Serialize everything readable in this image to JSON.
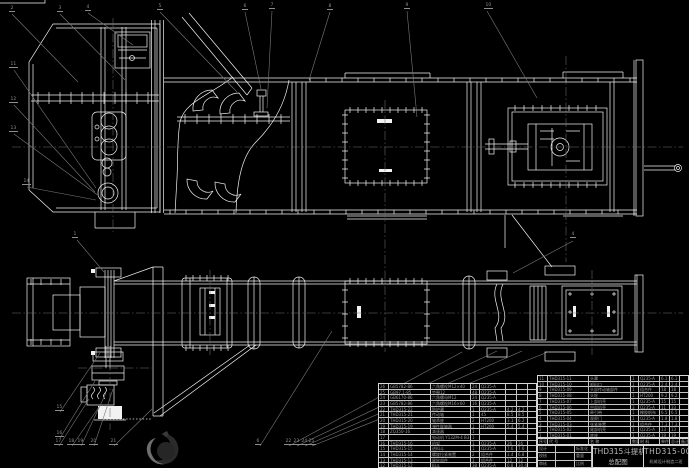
{
  "drawing": {
    "product_title": "THD315斗提机",
    "sheet_title": "总配图",
    "drawing_number": "THD315-00",
    "org_line": "机械设计制造二班"
  },
  "title_block": {
    "sign_rows": [
      [
        "设计",
        "",
        "标准化"
      ],
      [
        "校核",
        "",
        "重量"
      ],
      [
        "审核",
        "",
        "比例"
      ]
    ]
  },
  "bom": {
    "headers": [
      "序号",
      "代  号",
      "名  称",
      "数量",
      "材  料",
      "单件",
      "总计",
      "备注"
    ],
    "left_rows": [
      [
        "26",
        "GB5782-86",
        "六角螺栓M12×40",
        "24",
        "Q235-A",
        "",
        "",
        ""
      ],
      [
        "25",
        "GB97.1-85",
        "垫圈12",
        "48",
        "Q235-A",
        "",
        "",
        ""
      ],
      [
        "24",
        "GB6170-86",
        "六角螺母M12",
        "24",
        "Q235-A",
        "",
        "",
        ""
      ],
      [
        "23",
        "GB5782-86",
        "六角螺栓M16×60",
        "16",
        "Q235-A",
        "",
        "",
        ""
      ],
      [
        "22",
        "THD315-22",
        "防护罩",
        "1",
        "Q235-A",
        "4.2",
        "4.2",
        ""
      ],
      [
        "21",
        "THD315-21",
        "传动轴",
        "1",
        "45",
        "8.5",
        "8.5",
        ""
      ],
      [
        "20",
        "THD315-20",
        "轴承座",
        "2",
        "HT200",
        "3.1",
        "6.2",
        ""
      ],
      [
        "19",
        "THD315-19",
        "弹性联轴器",
        "1",
        "HT200",
        "5.4",
        "5.4",
        ""
      ],
      [
        "18",
        "ZQ350-16",
        "减速器",
        "1",
        "",
        "",
        "",
        ""
      ],
      [
        "17",
        "",
        "电动机 Y132M-4 B3",
        "1",
        "",
        "",
        "",
        ""
      ],
      [
        "16",
        "THD315-16",
        "机架",
        "1",
        "Q235-A",
        "26",
        "26",
        ""
      ],
      [
        "15",
        "THD315-15",
        "进料斗",
        "1",
        "Q235-A",
        "7.6",
        "7.6",
        ""
      ],
      [
        "14",
        "THD315-14",
        "螺旋拉紧装置",
        "2",
        "组合件",
        "3.4",
        "6.8",
        ""
      ],
      [
        "13",
        "THD315-13",
        "尾轮部件",
        "1",
        "组合件",
        "12",
        "12",
        ""
      ],
      [
        "12",
        "THD315-12",
        "料斗",
        "38",
        "Q235-A",
        "0.8",
        "30.4",
        ""
      ]
    ],
    "right_rows": [
      [
        "11",
        "THD315-11",
        "头罩",
        "1",
        "Q235-A",
        "6.1",
        "6.1",
        ""
      ],
      [
        "10",
        "THD315-10",
        "卸料口",
        "1",
        "Q235-A",
        "2.4",
        "2.4",
        ""
      ],
      [
        "9",
        "THD315-09",
        "头部传动轴部件",
        "1",
        "组合件",
        "18",
        "18",
        ""
      ],
      [
        "8",
        "THD315-08",
        "头轮",
        "1",
        "HT200",
        "9.2",
        "9.2",
        ""
      ],
      [
        "7",
        "THD315-07",
        "上部机壳",
        "1",
        "Q235-A",
        "15",
        "15",
        ""
      ],
      [
        "6",
        "THD315-06",
        "中部机壳",
        "3",
        "Q235-A",
        "11",
        "33",
        ""
      ],
      [
        "5",
        "THD315-05",
        "牵引带",
        "1",
        "橡胶帆布",
        "6.5",
        "6.5",
        ""
      ],
      [
        "4",
        "THD315-04",
        "观察门",
        "1",
        "Q235-A",
        "1.8",
        "1.8",
        ""
      ],
      [
        "3",
        "THD315-03",
        "张紧装置",
        "1",
        "组合件",
        "7.3",
        "7.3",
        ""
      ],
      [
        "2",
        "THD315-02",
        "尾部机壳",
        "1",
        "Q235-A",
        "13",
        "13",
        ""
      ],
      [
        "1",
        "THD315-01",
        "底座",
        "1",
        "Q235-A",
        "19",
        "19",
        ""
      ]
    ]
  },
  "callouts": [
    {
      "x": 12,
      "y": 12,
      "label": "2"
    },
    {
      "x": 60,
      "y": 12,
      "label": "3"
    },
    {
      "x": 88,
      "y": 11,
      "label": "4"
    },
    {
      "x": 160,
      "y": 10,
      "label": "5"
    },
    {
      "x": 245,
      "y": 10,
      "label": "6"
    },
    {
      "x": 272,
      "y": 9,
      "label": "7"
    },
    {
      "x": 330,
      "y": 10,
      "label": "8"
    },
    {
      "x": 407,
      "y": 9,
      "label": "9"
    },
    {
      "x": 487,
      "y": 9,
      "label": "10"
    },
    {
      "x": 12,
      "y": 68,
      "label": "11"
    },
    {
      "x": 12,
      "y": 103,
      "label": "12"
    },
    {
      "x": 12,
      "y": 132,
      "label": "13"
    },
    {
      "x": 25,
      "y": 185,
      "label": "14"
    },
    {
      "x": 75,
      "y": 238,
      "label": "1"
    },
    {
      "x": 573,
      "y": 238,
      "label": "4"
    },
    {
      "x": 58,
      "y": 411,
      "label": "15"
    },
    {
      "x": 58,
      "y": 437,
      "label": "16"
    },
    {
      "x": 57,
      "y": 445,
      "label": "17"
    },
    {
      "x": 70,
      "y": 445,
      "label": "18"
    },
    {
      "x": 79,
      "y": 445,
      "label": "19"
    },
    {
      "x": 92,
      "y": 445,
      "label": "20"
    },
    {
      "x": 112,
      "y": 445,
      "label": "21"
    },
    {
      "x": 258,
      "y": 445,
      "label": "6"
    },
    {
      "x": 287,
      "y": 445,
      "label": "22"
    },
    {
      "x": 295,
      "y": 445,
      "label": "23"
    },
    {
      "x": 303,
      "y": 445,
      "label": "24"
    },
    {
      "x": 310,
      "y": 445,
      "label": "25"
    }
  ],
  "colors": {
    "background": "#000000",
    "line": "#f2f2f2",
    "leader": "#7a7a7a",
    "table_text": "#9c9c9c",
    "title_text": "#b8b8b8"
  }
}
